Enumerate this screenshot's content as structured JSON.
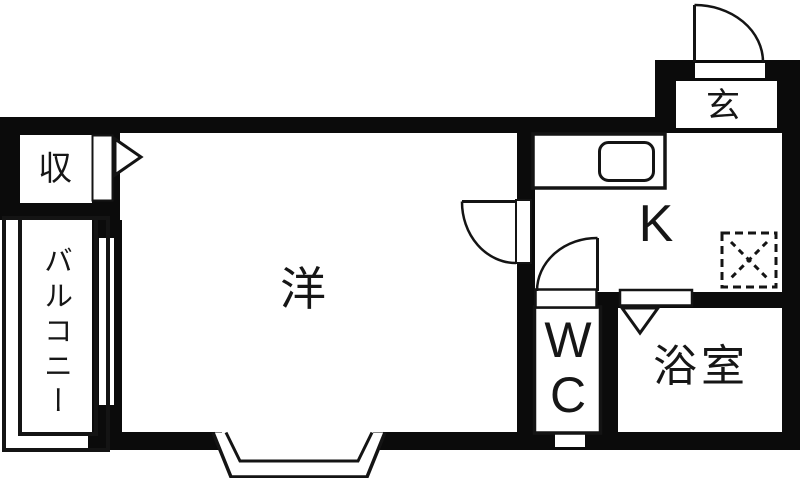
{
  "colors": {
    "wall": "#0b0b0b",
    "background": "#ffffff",
    "line": "#1a1a1a"
  },
  "rooms": {
    "closet": {
      "label": "収"
    },
    "balcony": {
      "label": "バルコニー"
    },
    "western_room": {
      "label": "洋"
    },
    "kitchen": {
      "label": "K"
    },
    "entrance": {
      "label": "玄"
    },
    "toilet": {
      "label": "W\nC"
    },
    "bathroom": {
      "label": "浴室"
    }
  },
  "fixtures": {
    "sink": "kitchen-sink",
    "refrigerator": "refrigerator-space-dashed-square",
    "bay_window": "bay-window-trapezoid",
    "balcony_window": "balcony-sliding-window",
    "wc_window": "wc-small-window",
    "doors": [
      "entrance-swing-door",
      "western-room-swing-door",
      "kitchen-swing-door",
      "bathroom-folding-door",
      "closet-folding-door"
    ]
  }
}
